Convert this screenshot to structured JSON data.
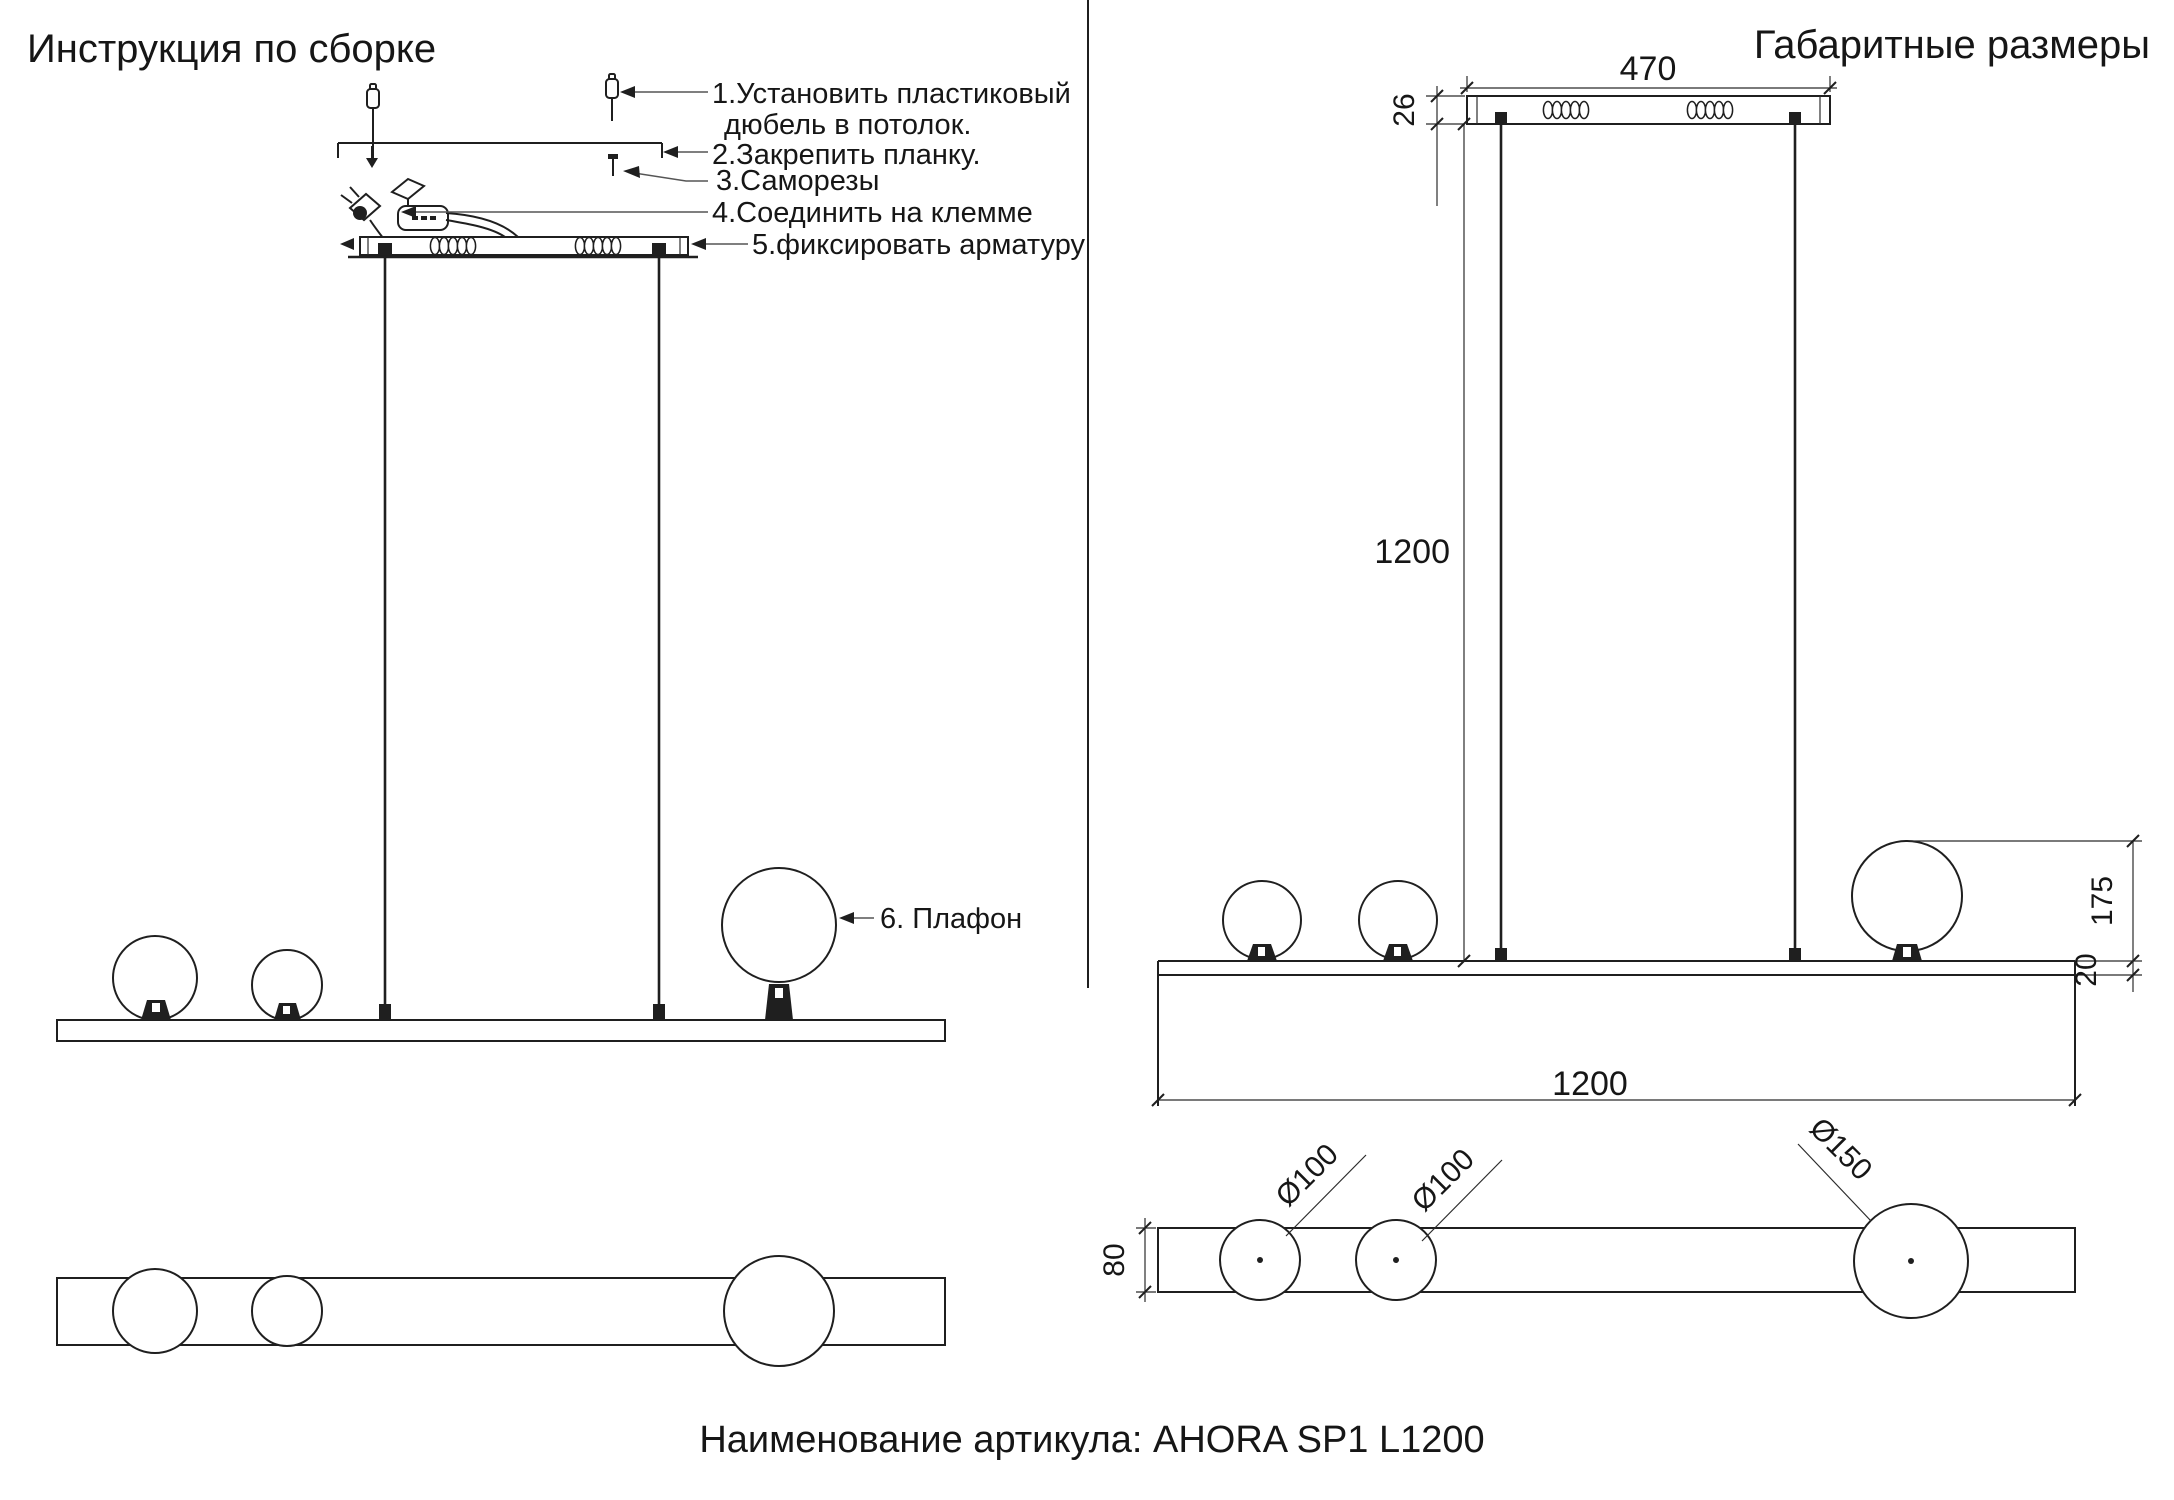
{
  "colors": {
    "background": "#ffffff",
    "line": "#1f1f1f",
    "leader": "#555555"
  },
  "left_panel": {
    "title": "Инструкция по сборке",
    "steps": {
      "step1_line1": "1.Установить пластиковый",
      "step1_line2": "дюбель в потолок.",
      "step2": "2.Закрепить планку.",
      "step3": "3.Саморезы",
      "step4": "4.Соединить на клемме",
      "step5": "5.фиксировать арматуру",
      "step6": "6. Плафон"
    }
  },
  "right_panel": {
    "title": "Габаритные размеры",
    "dims": {
      "canopy_length": "470",
      "canopy_height": "26",
      "suspension_height": "1200",
      "bar_length": "1200",
      "shade_to_bar_height": "175",
      "bar_thickness": "20",
      "bar_depth": "80",
      "dia_small_1": "Ø100",
      "dia_small_2": "Ø100",
      "dia_large": "Ø150"
    }
  },
  "footer": {
    "article_label": "Наименование артикула: AHORA SP1 L1200"
  }
}
